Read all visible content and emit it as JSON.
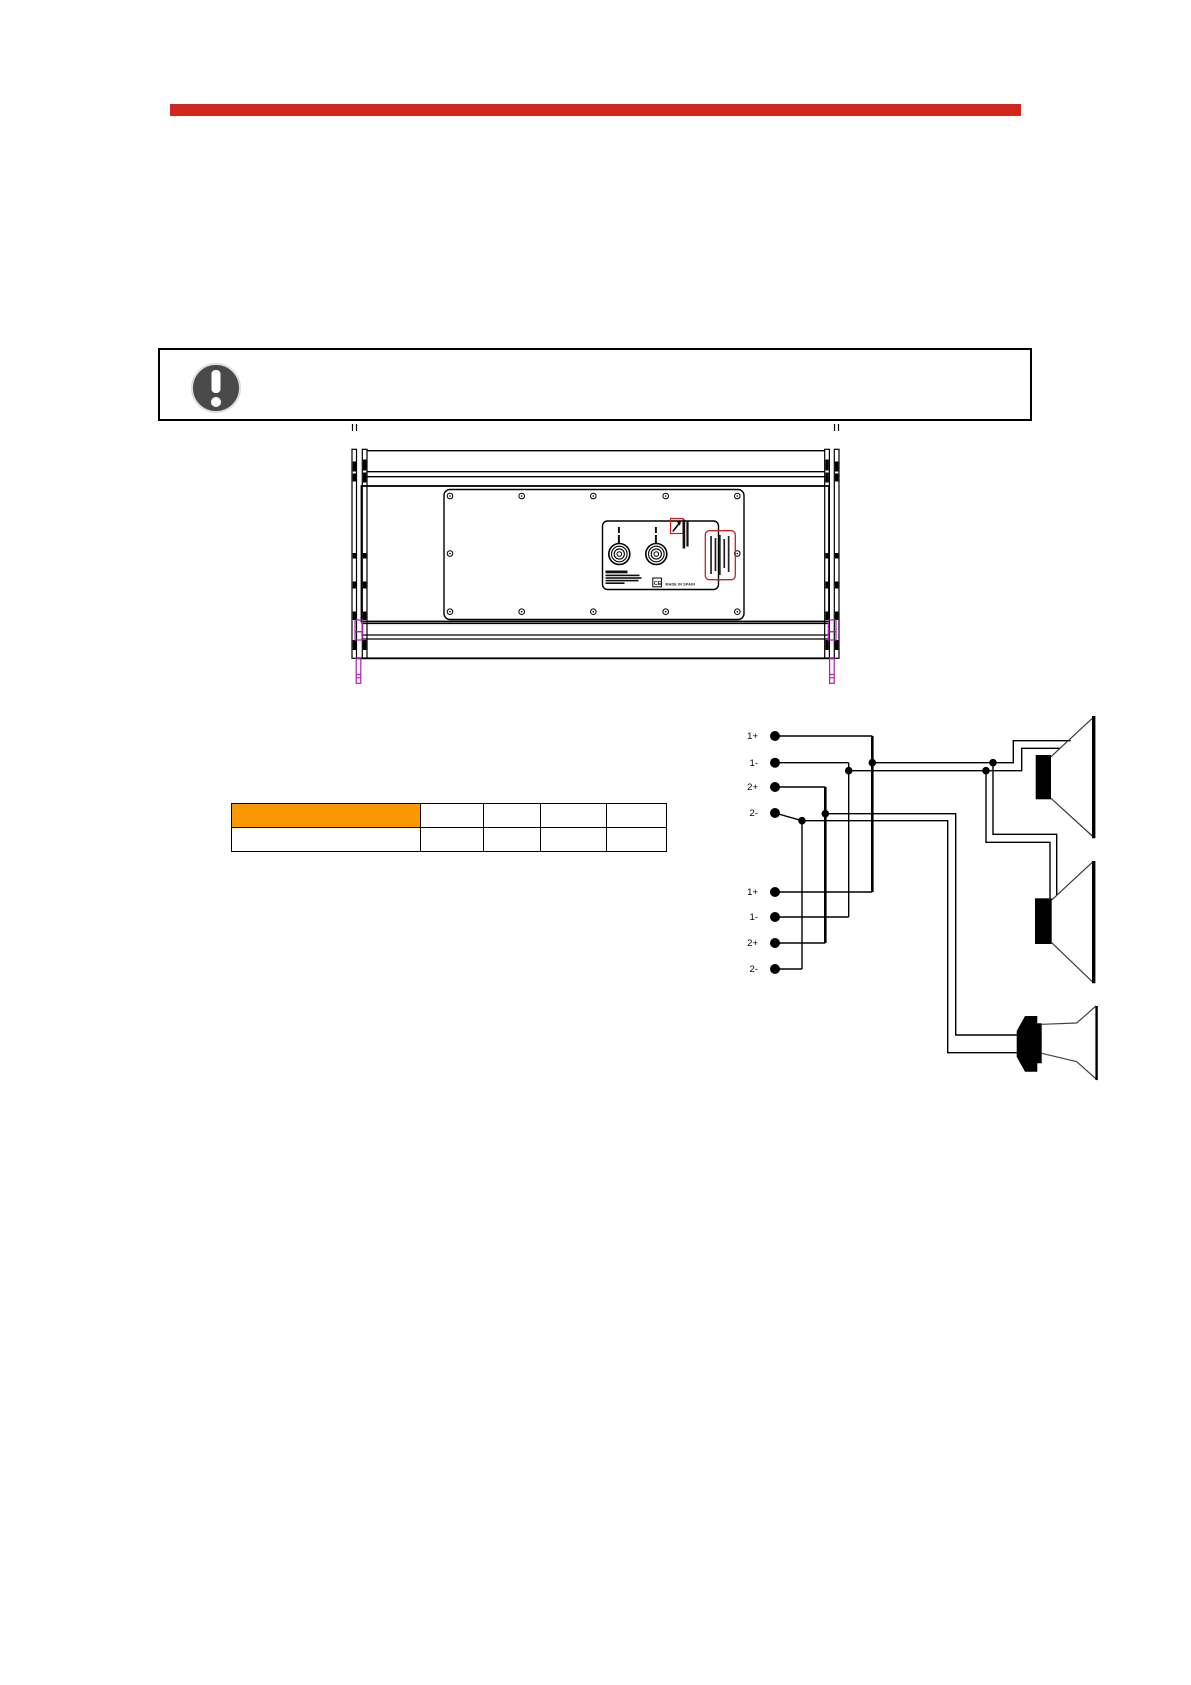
{
  "page": {
    "width": 1191,
    "height": 1685,
    "background": "#ffffff"
  },
  "accent_rule": {
    "color": "#d3271d"
  },
  "notice_box": {
    "icon": "exclamation-circle",
    "icon_color": "#4a4a4a",
    "border_color": "#000000"
  },
  "cabinet_drawing": {
    "description": "rear-view engineering line drawing of line-array loudspeaker cabinet with rigging rails",
    "labels": {
      "made_in": "MADE IN SPAIN",
      "ce_mark": "CE"
    },
    "colors": {
      "outline": "#000000",
      "rigging_pin": "#aa22aa",
      "label_red": "#cc2020"
    }
  },
  "spec_table": {
    "header_fill": "#fb9800",
    "columns": 5,
    "rows": 2,
    "cells": [
      [
        "",
        "",
        "",
        "",
        ""
      ],
      [
        "",
        "",
        "",
        "",
        ""
      ]
    ]
  },
  "wiring_diagram": {
    "terminal_groups": [
      {
        "terminals": [
          "1+",
          "1-",
          "2+",
          "2-"
        ]
      },
      {
        "terminals": [
          "1+",
          "1-",
          "2+",
          "2-"
        ]
      }
    ],
    "drivers": [
      "woofer",
      "woofer",
      "compression-driver-horn"
    ]
  }
}
